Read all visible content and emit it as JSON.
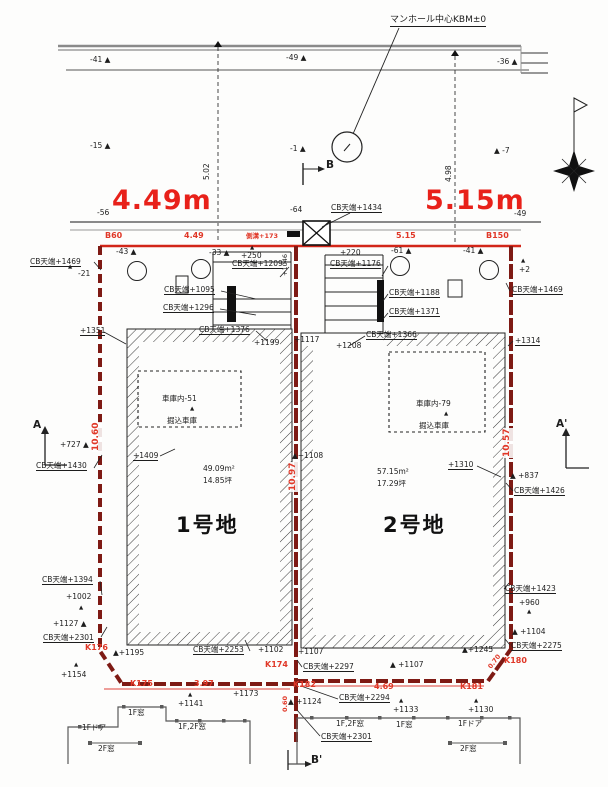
{
  "title": "宅地分譲区画図",
  "colors": {
    "dimension_red": "#e8211a",
    "boundary_dark_red": "#7e1a14",
    "survey_red": "#e03828",
    "line_black": "#1d1d1d",
    "road_gray": "#8a8a8a"
  },
  "plots": [
    {
      "name": "1号地",
      "area_m2": "49.09m²",
      "area_tsubo": "14.85坪",
      "frontage": "4.49m",
      "depth_left": "10.60",
      "depth_right": "10.97",
      "garage": "車庫内-51 掘込車庫"
    },
    {
      "name": "2号地",
      "area_m2": "57.15m²",
      "area_tsubo": "17.29坪",
      "frontage": "5.15m",
      "depth_left": "10.97",
      "depth_right": "10.57",
      "garage": "車庫内-79 掘込車庫"
    }
  ],
  "benchmark": "マンホール中心KBM±0",
  "annotations": [
    {
      "n": "kbm-label",
      "t": "マンホール中心KBM±0",
      "x": 390,
      "y": 16,
      "c": "s9 u"
    },
    {
      "n": "spot-elevation",
      "t": "-41 ▲",
      "x": 90,
      "y": 56
    },
    {
      "n": "spot-elevation",
      "t": "-49 ▲",
      "x": 286,
      "y": 54
    },
    {
      "n": "spot-elevation",
      "t": "-36 ▲",
      "x": 497,
      "y": 58
    },
    {
      "n": "spot-elevation",
      "t": "-15 ▲",
      "x": 90,
      "y": 142
    },
    {
      "n": "spot-elevation",
      "t": "-1 ▲",
      "x": 290,
      "y": 145
    },
    {
      "n": "spot-elevation",
      "t": "▲ -7",
      "x": 494,
      "y": 147
    },
    {
      "n": "dim-rot",
      "t": "5.02",
      "x": 203,
      "y": 180,
      "c": "rot"
    },
    {
      "n": "dim-rot",
      "t": "4.98",
      "x": 445,
      "y": 182,
      "c": "rot"
    },
    {
      "n": "section-label",
      "t": "B",
      "x": 326,
      "y": 160,
      "c": "s10"
    },
    {
      "n": "frontage-dim",
      "t": "4.49m",
      "x": 112,
      "y": 186,
      "c": "red big"
    },
    {
      "n": "frontage-dim",
      "t": "5.15m",
      "x": 425,
      "y": 186,
      "c": "red big"
    },
    {
      "n": "spot-elevation",
      "t": "-56",
      "x": 97,
      "y": 209
    },
    {
      "n": "spot-elevation",
      "t": "-64",
      "x": 290,
      "y": 206
    },
    {
      "n": "spot-elevation",
      "t": "-49",
      "x": 514,
      "y": 210
    },
    {
      "n": "cb-level",
      "t": "CB天端+1434",
      "x": 331,
      "y": 204,
      "c": "u"
    },
    {
      "n": "boundary-dim",
      "t": "B60",
      "x": 105,
      "y": 232,
      "c": "red2"
    },
    {
      "n": "boundary-dim",
      "t": "4.49",
      "x": 184,
      "y": 232,
      "c": "red2"
    },
    {
      "n": "boundary-dim",
      "t": "側溝+173",
      "x": 246,
      "y": 233,
      "c": "red2 s7"
    },
    {
      "n": "boundary-dim",
      "t": "5.15",
      "x": 396,
      "y": 232,
      "c": "red2"
    },
    {
      "n": "boundary-dim",
      "t": "B150",
      "x": 486,
      "y": 232,
      "c": "red2"
    },
    {
      "n": "spot-elevation",
      "t": "-43 ▲",
      "x": 116,
      "y": 248
    },
    {
      "n": "spot-elevation",
      "t": "-33 ▲",
      "x": 209,
      "y": 249
    },
    {
      "n": "triangle-marker",
      "t": "▲",
      "x": 250,
      "y": 245,
      "c": "s6"
    },
    {
      "n": "spot-elevation",
      "t": "+250",
      "x": 241,
      "y": 252
    },
    {
      "n": "spot-elevation",
      "t": "+220",
      "x": 340,
      "y": 249
    },
    {
      "n": "spot-elevation",
      "t": "-61 ▲",
      "x": 391,
      "y": 247
    },
    {
      "n": "spot-elevation",
      "t": "-41 ▲",
      "x": 463,
      "y": 247
    },
    {
      "n": "triangle-marker",
      "t": "▲",
      "x": 521,
      "y": 258,
      "c": "s6"
    },
    {
      "n": "spot-elevation",
      "t": "+2",
      "x": 519,
      "y": 266
    },
    {
      "n": "cb-level",
      "t": "CB天端+1469",
      "x": 30,
      "y": 258,
      "c": "u"
    },
    {
      "n": "triangle-marker",
      "t": "▲",
      "x": 68,
      "y": 264,
      "c": "s6"
    },
    {
      "n": "spot-elevation",
      "t": "-21",
      "x": 78,
      "y": 270
    },
    {
      "n": "cb-level",
      "t": "CB天端+1209",
      "x": 232,
      "y": 260,
      "c": "u"
    },
    {
      "n": "cb-level",
      "t": "CB天端+1095",
      "x": 164,
      "y": 286,
      "c": "u"
    },
    {
      "n": "cb-level",
      "t": "CB天端+1296",
      "x": 163,
      "y": 304,
      "c": "u"
    },
    {
      "n": "cb-level",
      "t": "CB天端+1376",
      "x": 199,
      "y": 326,
      "c": "u"
    },
    {
      "n": "spot-elevation",
      "t": "+1199",
      "x": 254,
      "y": 339
    },
    {
      "n": "cb-level",
      "t": "CB天端+1176",
      "x": 330,
      "y": 260,
      "c": "u"
    },
    {
      "n": "cb-level",
      "t": "CB天端+1188",
      "x": 389,
      "y": 289,
      "c": "u"
    },
    {
      "n": "cb-level",
      "t": "CB天端+1371",
      "x": 389,
      "y": 308,
      "c": "u"
    },
    {
      "n": "cb-level",
      "t": "CB天端+1366",
      "x": 366,
      "y": 331,
      "c": "u"
    },
    {
      "n": "spot-elevation",
      "t": "+1117",
      "x": 294,
      "y": 336
    },
    {
      "n": "spot-elevation",
      "t": "+1208",
      "x": 336,
      "y": 342
    },
    {
      "n": "rot-label",
      "t": "+1046",
      "x": 282,
      "y": 276,
      "c": "rot s7"
    },
    {
      "n": "cb-level",
      "t": "CB天端+1469",
      "x": 512,
      "y": 286,
      "c": "u"
    },
    {
      "n": "cb-level",
      "t": "+1351",
      "x": 80,
      "y": 327,
      "c": "u"
    },
    {
      "n": "cb-level",
      "t": "+1314",
      "x": 515,
      "y": 337,
      "c": "u"
    },
    {
      "n": "section-label",
      "t": "A",
      "x": 33,
      "y": 420,
      "c": "s10"
    },
    {
      "n": "spot-elevation",
      "t": "+727 ▲",
      "x": 60,
      "y": 441
    },
    {
      "n": "cb-level",
      "t": "CB天端+1430",
      "x": 36,
      "y": 462,
      "c": "u"
    },
    {
      "n": "dim-rot",
      "t": "10.60",
      "x": 92,
      "y": 452,
      "c": "rot red2 bg s9"
    },
    {
      "n": "cb-level",
      "t": "+1409",
      "x": 133,
      "y": 452,
      "c": "u"
    },
    {
      "n": "area-label",
      "t": "49.09m²",
      "x": 203,
      "y": 465
    },
    {
      "n": "area-label",
      "t": "14.85坪",
      "x": 203,
      "y": 477
    },
    {
      "n": "plot-name",
      "t": "1号地",
      "x": 176,
      "y": 514,
      "c": "plot"
    },
    {
      "n": "spot-elevation",
      "t": "▲+1108",
      "x": 292,
      "y": 452
    },
    {
      "n": "dim-rot",
      "t": "10.97",
      "x": 289,
      "y": 492,
      "c": "rot red2 bg s9"
    },
    {
      "n": "garage-label",
      "t": "車庫内-51",
      "x": 162,
      "y": 395
    },
    {
      "n": "triangle-marker",
      "t": "▲",
      "x": 190,
      "y": 406,
      "c": "s6"
    },
    {
      "n": "garage-label",
      "t": "掘込車庫",
      "x": 167,
      "y": 417
    },
    {
      "n": "garage-label",
      "t": "車庫内-79",
      "x": 416,
      "y": 400
    },
    {
      "n": "triangle-marker",
      "t": "▲",
      "x": 444,
      "y": 411,
      "c": "s6"
    },
    {
      "n": "garage-label",
      "t": "掘込車庫",
      "x": 419,
      "y": 422
    },
    {
      "n": "area-label",
      "t": "57.15m²",
      "x": 377,
      "y": 468
    },
    {
      "n": "area-label",
      "t": "17.29坪",
      "x": 377,
      "y": 480
    },
    {
      "n": "plot-name",
      "t": "2号地",
      "x": 383,
      "y": 514,
      "c": "plot"
    },
    {
      "n": "cb-level",
      "t": "+1310",
      "x": 448,
      "y": 461,
      "c": "u"
    },
    {
      "n": "spot-elevation",
      "t": "▲ +837",
      "x": 510,
      "y": 472
    },
    {
      "n": "cb-level",
      "t": "CB天端+1426",
      "x": 514,
      "y": 487,
      "c": "u"
    },
    {
      "n": "dim-rot",
      "t": "10.57",
      "x": 503,
      "y": 458,
      "c": "rot red2 bg s9"
    },
    {
      "n": "section-label",
      "t": "A'",
      "x": 556,
      "y": 419,
      "c": "s10"
    },
    {
      "n": "cb-level",
      "t": "CB天端+1423",
      "x": 505,
      "y": 585,
      "c": "u"
    },
    {
      "n": "spot-elevation",
      "t": "+960",
      "x": 519,
      "y": 599
    },
    {
      "n": "triangle-marker",
      "t": "▲",
      "x": 527,
      "y": 609,
      "c": "s6"
    },
    {
      "n": "spot-elevation",
      "t": "▲ +1104",
      "x": 512,
      "y": 628
    },
    {
      "n": "cb-level",
      "t": "CB天端+2275",
      "x": 511,
      "y": 642,
      "c": "u"
    },
    {
      "n": "survey-point",
      "t": "K180",
      "x": 504,
      "y": 657,
      "c": "red2"
    },
    {
      "n": "dim-rot",
      "t": "0.70",
      "x": 487,
      "y": 666,
      "c": "rot52 red2 s7"
    },
    {
      "n": "survey-point",
      "t": "K181",
      "x": 460,
      "y": 683,
      "c": "red2"
    },
    {
      "n": "spot-elevation",
      "t": "▲+1245",
      "x": 462,
      "y": 646
    },
    {
      "n": "cb-level",
      "t": "CB天端+1394",
      "x": 42,
      "y": 576,
      "c": "u"
    },
    {
      "n": "spot-elevation",
      "t": "+1002",
      "x": 66,
      "y": 593
    },
    {
      "n": "triangle-marker",
      "t": "▲",
      "x": 79,
      "y": 605,
      "c": "s6"
    },
    {
      "n": "spot-elevation",
      "t": "+1127 ▲",
      "x": 53,
      "y": 620
    },
    {
      "n": "cb-level",
      "t": "CB天端+2301",
      "x": 43,
      "y": 634,
      "c": "u"
    },
    {
      "n": "survey-point",
      "t": "K176",
      "x": 85,
      "y": 644,
      "c": "red2"
    },
    {
      "n": "triangle-marker",
      "t": "▲",
      "x": 74,
      "y": 662,
      "c": "s6"
    },
    {
      "n": "spot-elevation",
      "t": "+1154",
      "x": 61,
      "y": 671
    },
    {
      "n": "spot-elevation",
      "t": "▲+1195",
      "x": 113,
      "y": 649
    },
    {
      "n": "survey-point",
      "t": "K175",
      "x": 130,
      "y": 680,
      "c": "red2"
    },
    {
      "n": "boundary-dim",
      "t": "3.97",
      "x": 194,
      "y": 680,
      "c": "red2"
    },
    {
      "n": "cb-level",
      "t": "CB天端+2253",
      "x": 193,
      "y": 646,
      "c": "u"
    },
    {
      "n": "spot-elevation",
      "t": "+1102",
      "x": 258,
      "y": 646
    },
    {
      "n": "survey-point",
      "t": "K174",
      "x": 265,
      "y": 661,
      "c": "red2"
    },
    {
      "n": "spot-elevation",
      "t": "+1107",
      "x": 298,
      "y": 648
    },
    {
      "n": "cb-level",
      "t": "CB天端+2297",
      "x": 303,
      "y": 663,
      "c": "u"
    },
    {
      "n": "spot-elevation",
      "t": "▲ +1107",
      "x": 390,
      "y": 661
    },
    {
      "n": "boundary-dim",
      "t": "4.69",
      "x": 374,
      "y": 683,
      "c": "red2"
    },
    {
      "n": "cb-level",
      "t": "CB天端+2294",
      "x": 339,
      "y": 694,
      "c": "u"
    },
    {
      "n": "triangle-marker",
      "t": "▲",
      "x": 399,
      "y": 698,
      "c": "s6"
    },
    {
      "n": "spot-elevation",
      "t": "+1133",
      "x": 393,
      "y": 706
    },
    {
      "n": "triangle-marker",
      "t": "▲",
      "x": 474,
      "y": 698,
      "c": "s6"
    },
    {
      "n": "spot-elevation",
      "t": "+1130",
      "x": 468,
      "y": 706
    },
    {
      "n": "spot-elevation",
      "t": "▲ +1124",
      "x": 288,
      "y": 698
    },
    {
      "n": "spot-elevation",
      "t": "+1173",
      "x": 233,
      "y": 690
    },
    {
      "n": "triangle-marker",
      "t": "▲",
      "x": 188,
      "y": 692,
      "c": "s6"
    },
    {
      "n": "spot-elevation",
      "t": "+1141",
      "x": 178,
      "y": 700
    },
    {
      "n": "survey-point",
      "t": "K182",
      "x": 293,
      "y": 681,
      "c": "red2"
    },
    {
      "n": "dim-rot",
      "t": "0.60",
      "x": 282,
      "y": 712,
      "c": "rot red2 s7"
    },
    {
      "n": "cb-level",
      "t": "CB天端+2301",
      "x": 321,
      "y": 733,
      "c": "u"
    },
    {
      "n": "section-label",
      "t": "B'",
      "x": 311,
      "y": 755,
      "c": "s10"
    },
    {
      "n": "window-label",
      "t": "1F窓",
      "x": 128,
      "y": 709
    },
    {
      "n": "window-label",
      "t": "1Fドア",
      "x": 82,
      "y": 724
    },
    {
      "n": "window-label",
      "t": "1F,2F窓",
      "x": 178,
      "y": 723
    },
    {
      "n": "window-label",
      "t": "2F窓",
      "x": 98,
      "y": 745
    },
    {
      "n": "window-label",
      "t": "1F,2F窓",
      "x": 336,
      "y": 720
    },
    {
      "n": "window-label",
      "t": "1F窓",
      "x": 396,
      "y": 721
    },
    {
      "n": "window-label",
      "t": "1Fドア",
      "x": 458,
      "y": 720
    },
    {
      "n": "window-label",
      "t": "2F窓",
      "x": 460,
      "y": 745
    }
  ]
}
